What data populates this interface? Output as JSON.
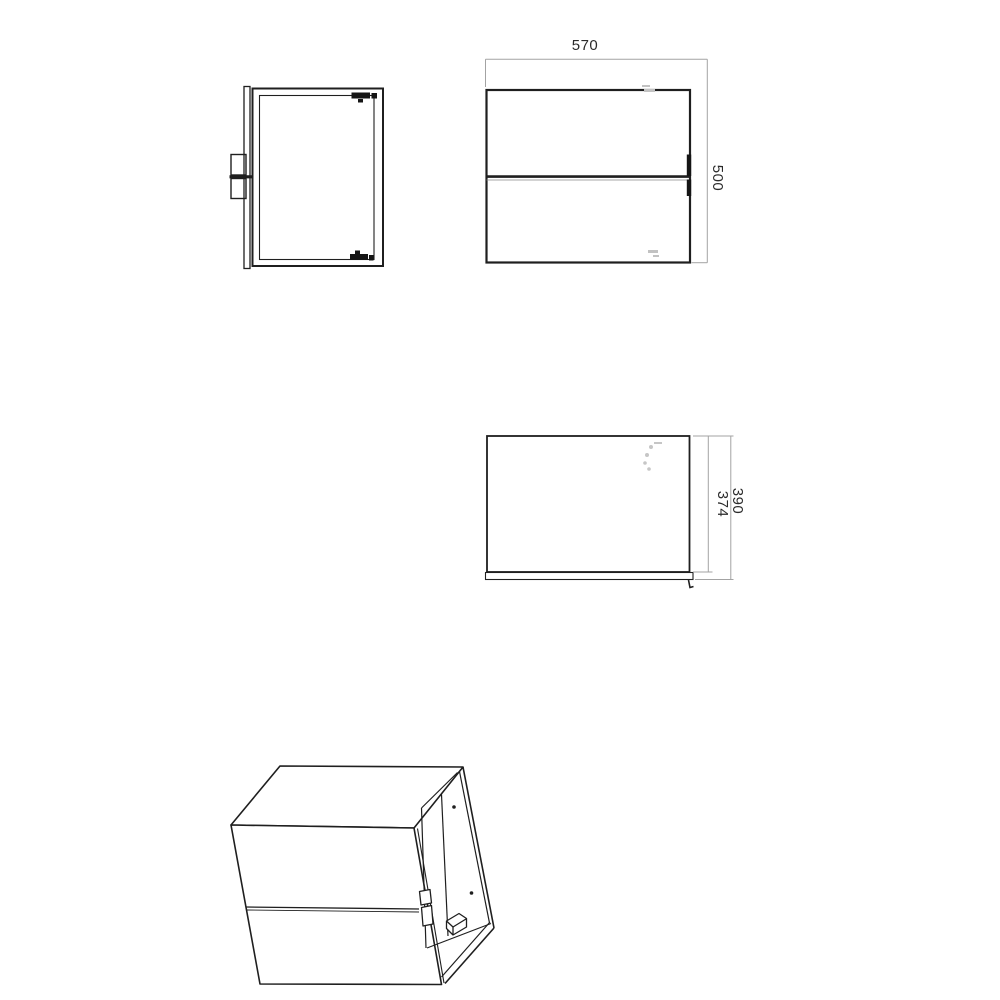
{
  "drawing": {
    "dimensions": {
      "width": "570",
      "height": "500",
      "depth_inner": "374",
      "depth_outer": "390"
    },
    "colors": {
      "background": "#ffffff",
      "outline": "#1f1f1f",
      "dim_line": "#a3a3a3",
      "text": "#2b2b2b"
    }
  }
}
